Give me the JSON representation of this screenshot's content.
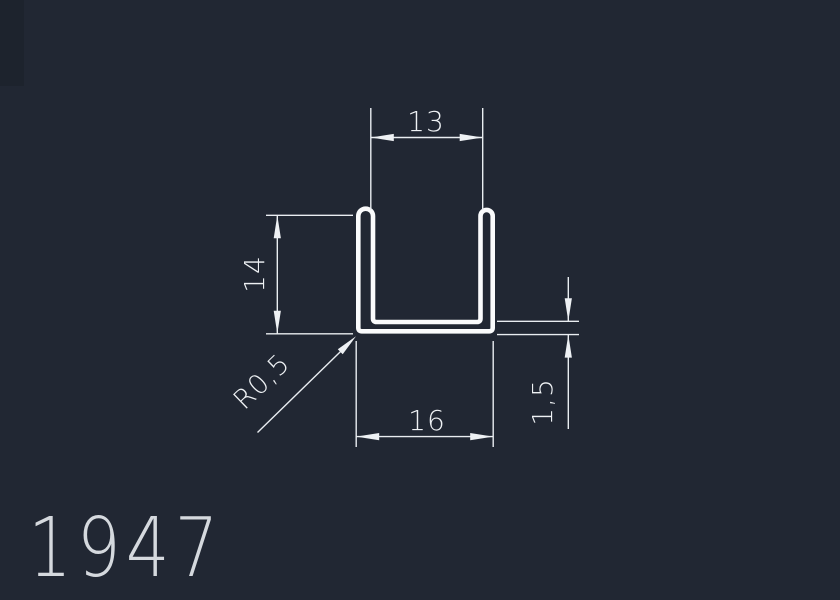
{
  "drawing": {
    "type": "profile-cross-section",
    "part_number": "1947",
    "dimensions": {
      "inner_width": "13",
      "height": "14",
      "outer_width": "16",
      "wall_thickness": "1,5",
      "corner_radius": "R0,5"
    },
    "colors": {
      "background": "#212733",
      "profile_line": "#fafbfc",
      "dimension_line": "#e9edf1",
      "part_number_text": "#d5d9de"
    }
  }
}
